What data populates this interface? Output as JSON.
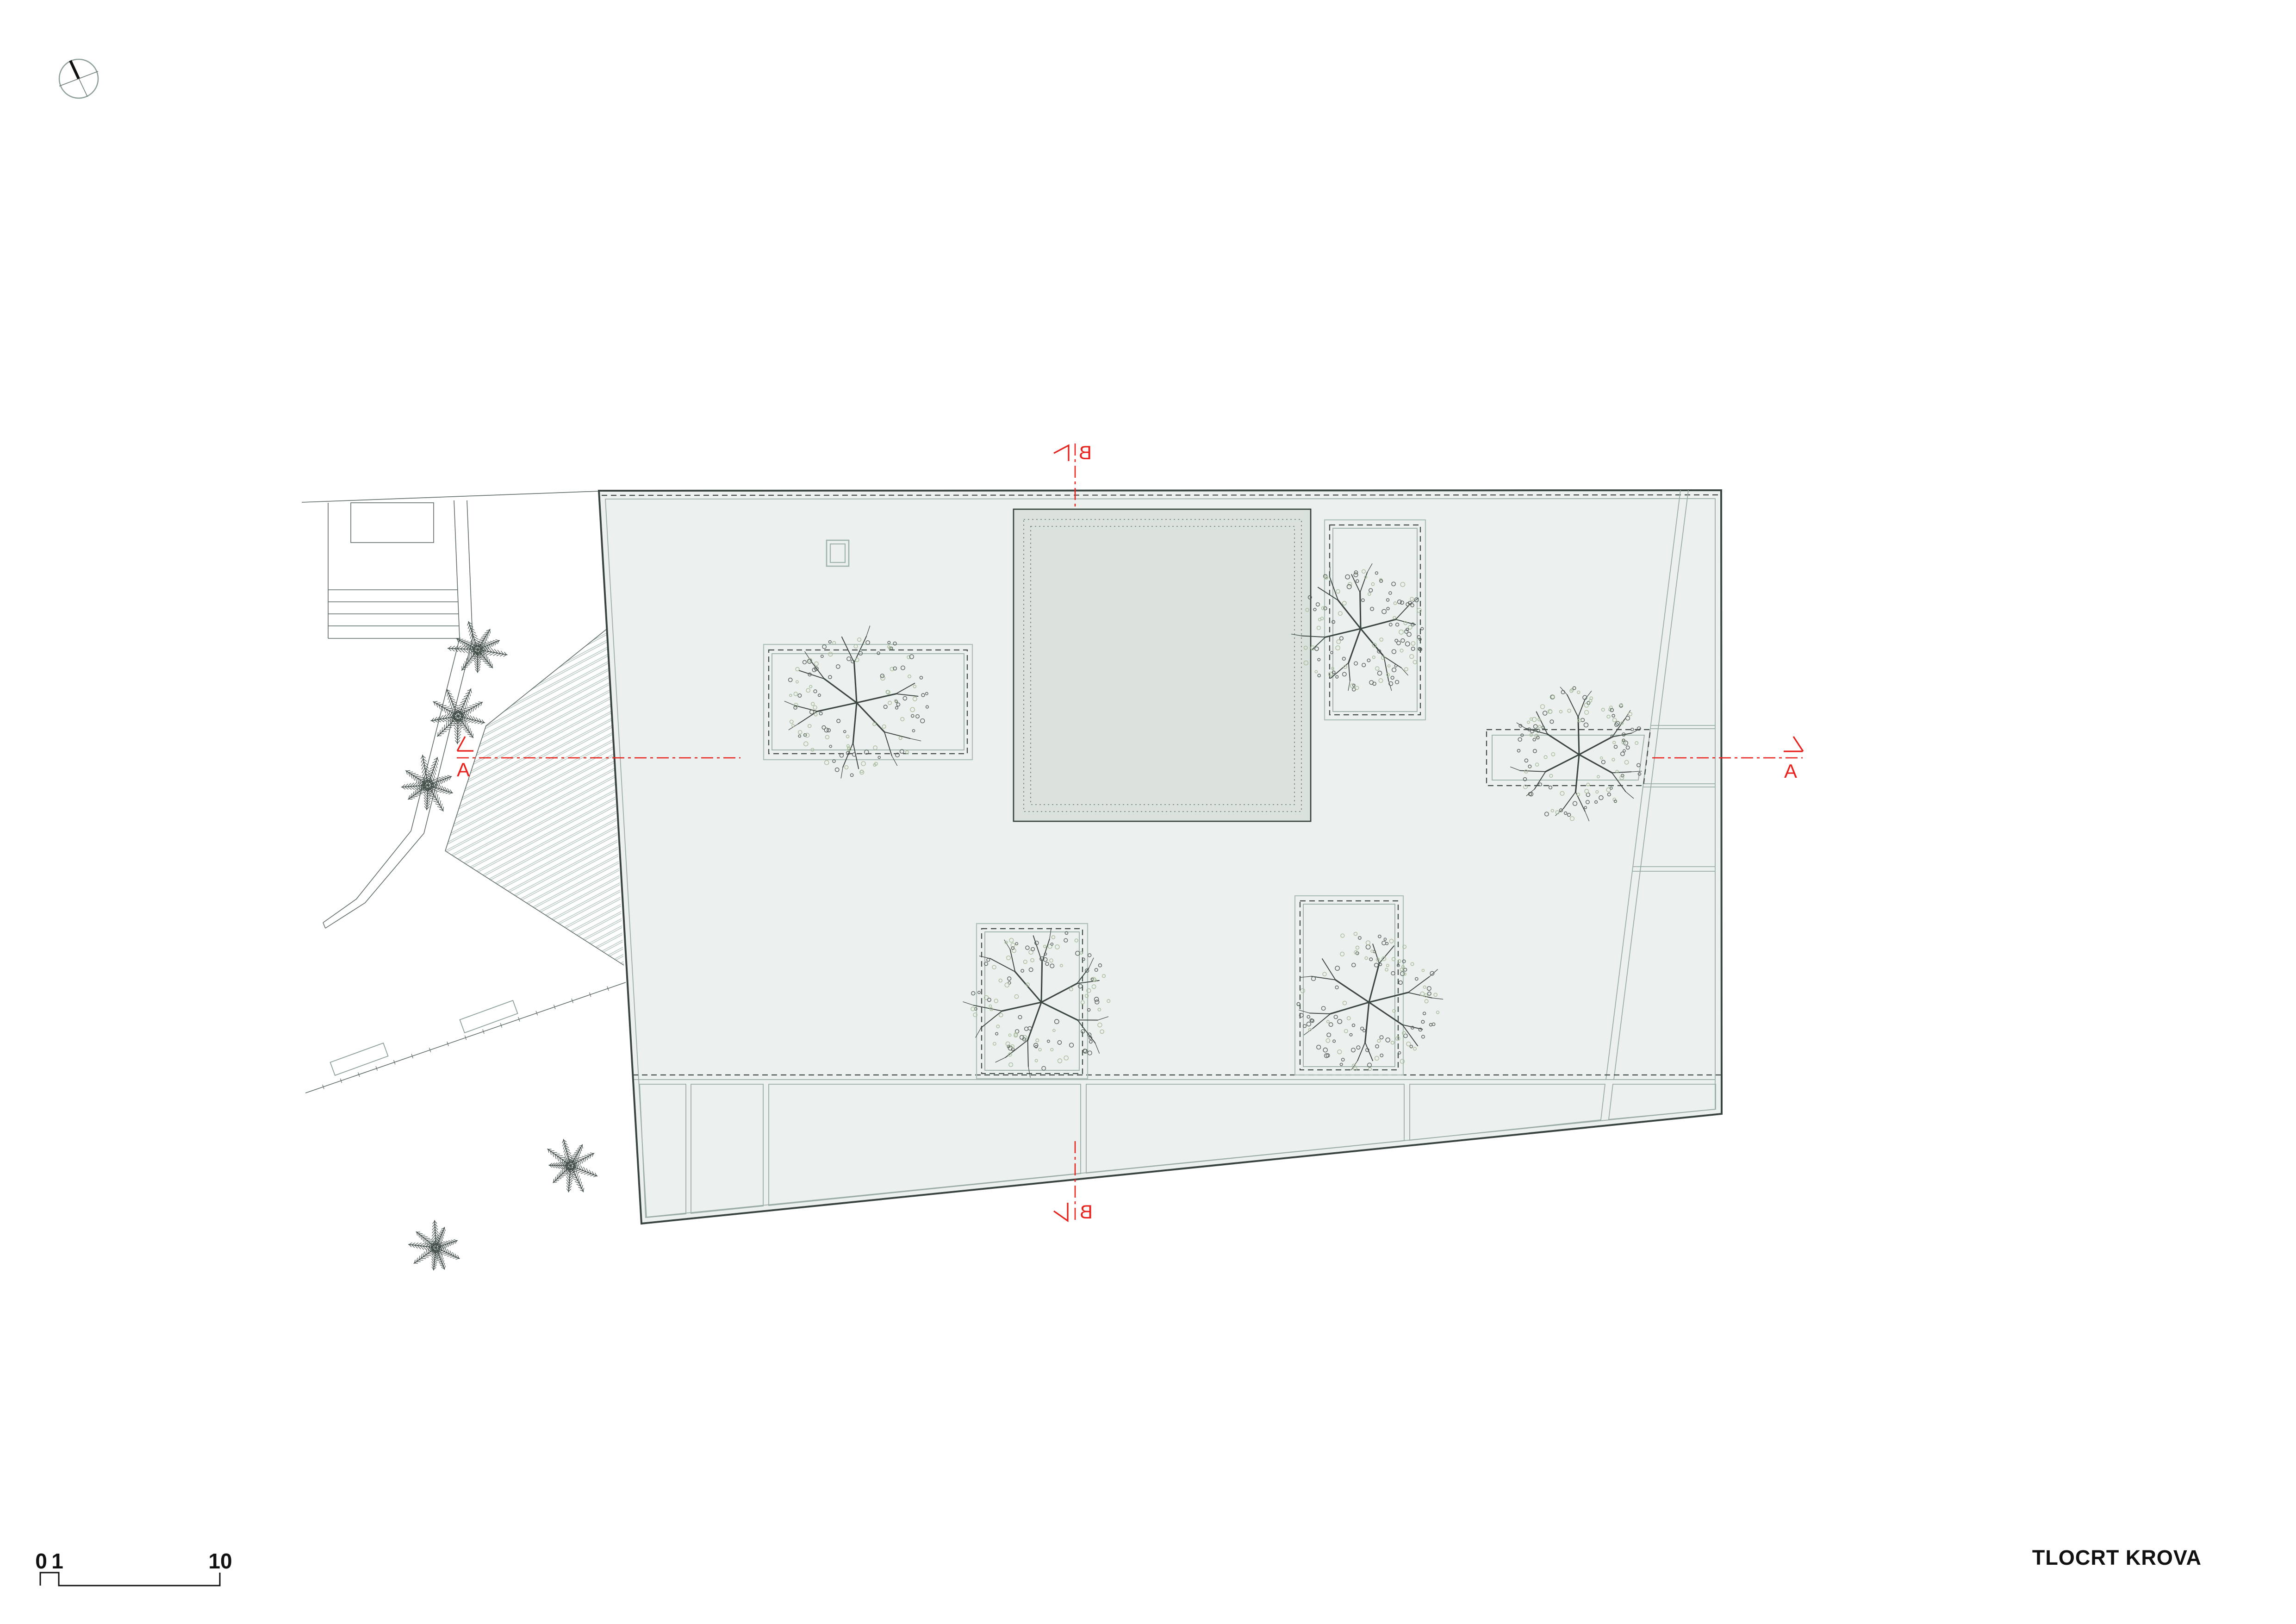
{
  "title": "TLOCRT KROVA",
  "scale_bar": {
    "zero": "0",
    "one": "1",
    "ten": "10"
  },
  "sections": {
    "a": "A",
    "b": "B"
  },
  "colors": {
    "red": "#e8211c",
    "roof": "#ecf0ee",
    "sky-light": "#dbe1dd",
    "sky-dark": "#d2dad4",
    "outline": "#39443f",
    "thin": "#9bada6",
    "site": "#5f6b66",
    "hatch": "#b6c5bf",
    "fol-dark": "#57615a",
    "fol-light": "#a9bc9d",
    "branch": "#3c4641",
    "fern": "#434e49",
    "text": "#111111"
  }
}
